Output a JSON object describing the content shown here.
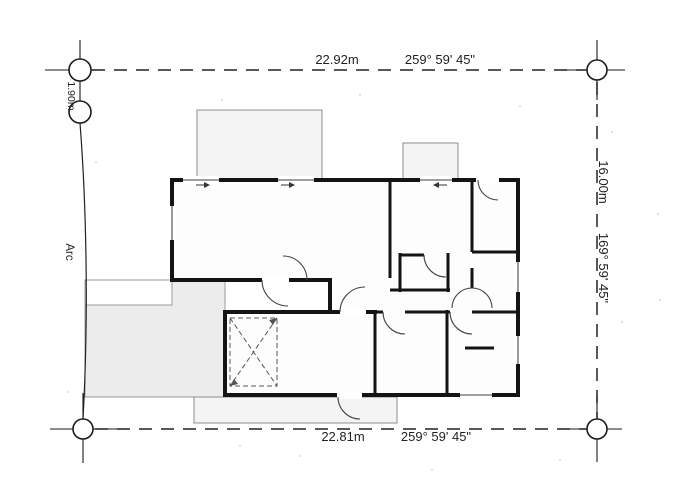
{
  "drawing_title": "Site plan with building floor plan",
  "boundary": {
    "top": {
      "length": "22.92m",
      "bearing": "259° 59' 45\""
    },
    "bottom": {
      "length": "22.81m",
      "bearing": "259° 59' 45\""
    },
    "right": {
      "length": "16.00m",
      "bearing": "169° 59' 45\""
    },
    "left": {
      "offset": "1.90m",
      "label": "Arc"
    }
  },
  "symbols": {
    "survey_marker": "circle-crosshair-icon",
    "void_area": "dashed-x-box",
    "door_swing": "quarter-arc",
    "window": "thin-wall-gap"
  },
  "colors": {
    "wall": "#141414",
    "boundary_line": "#222222",
    "porch_fill": "#f4f4f4",
    "driveway_fill": "#ececec",
    "outline_gray": "#8c8c8c",
    "paper": "#ffffff"
  }
}
